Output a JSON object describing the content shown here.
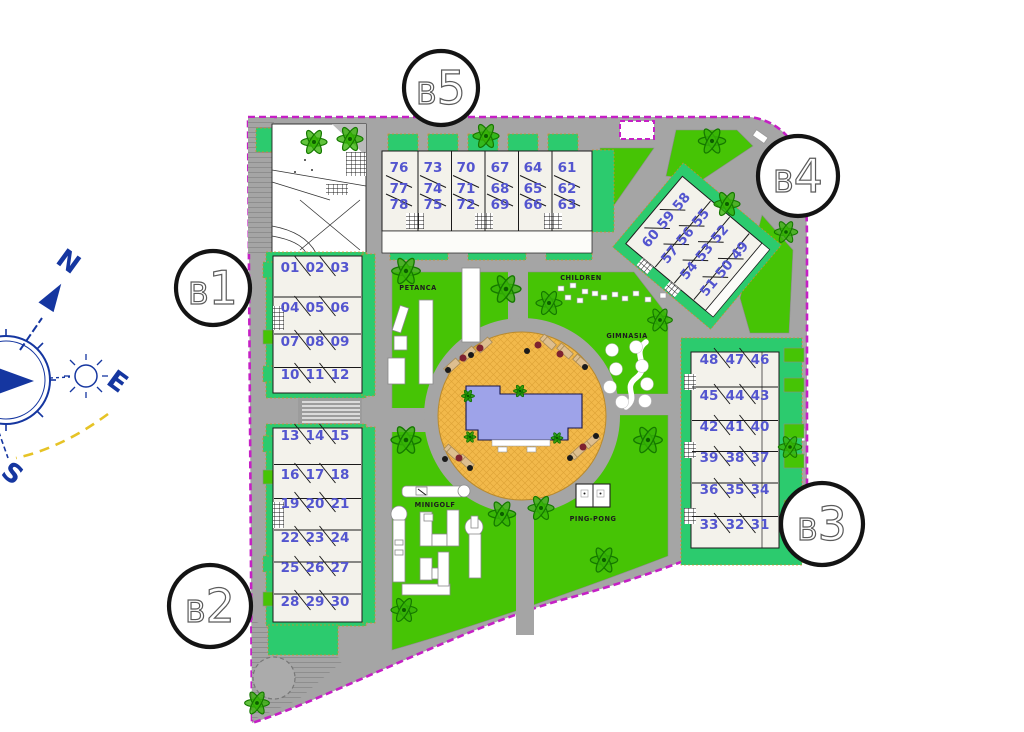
{
  "plan": {
    "blocks": [
      {
        "id": "B5",
        "label": "B5",
        "rows": [
          [
            "76",
            "73",
            "70",
            "67",
            "64",
            "61"
          ],
          [
            "77",
            "74",
            "71",
            "68",
            "65",
            "62"
          ],
          [
            "78",
            "75",
            "72",
            "69",
            "66",
            "63"
          ]
        ]
      },
      {
        "id": "B4",
        "label": "B4",
        "rows": [
          [
            "60",
            "59",
            "58"
          ],
          [
            "57",
            "56",
            "55"
          ],
          [
            "54",
            "53",
            "52"
          ],
          [
            "51",
            "50",
            "49"
          ]
        ]
      },
      {
        "id": "B1",
        "label": "B1",
        "rows": [
          [
            "01",
            "02",
            "03"
          ],
          [
            "04",
            "05",
            "06"
          ],
          [
            "07",
            "08",
            "09"
          ],
          [
            "10",
            "11",
            "12"
          ]
        ]
      },
      {
        "id": "B2",
        "label": "B2",
        "rows": [
          [
            "13",
            "14",
            "15"
          ],
          [
            "16",
            "17",
            "18"
          ],
          [
            "19",
            "20",
            "21"
          ],
          [
            "22",
            "23",
            "24"
          ],
          [
            "25",
            "26",
            "27"
          ],
          [
            "28",
            "29",
            "30"
          ]
        ]
      },
      {
        "id": "B3",
        "label": "B3",
        "rows": [
          [
            "48",
            "47",
            "46"
          ],
          [
            "45",
            "44",
            "43"
          ],
          [
            "42",
            "41",
            "40"
          ],
          [
            "39",
            "38",
            "37"
          ],
          [
            "36",
            "35",
            "34"
          ],
          [
            "33",
            "32",
            "31"
          ]
        ]
      }
    ],
    "amenities": {
      "petanca": "PETANCA",
      "children": "CHILDREN",
      "gimnasia": "GIMNASIA",
      "minigolf": "MINIGOLF",
      "pingpong": "PING-PONG"
    },
    "compass": {
      "north": "N",
      "east": "E",
      "south": "S"
    },
    "colors": {
      "boundary": "#C520C5",
      "lawn": "#46C405",
      "garden": "#2CCB6E",
      "road": "#A5A5A5",
      "pool": "#9EA3E9",
      "deck": "#F2B94B",
      "unit_number": "#5355CF"
    }
  }
}
